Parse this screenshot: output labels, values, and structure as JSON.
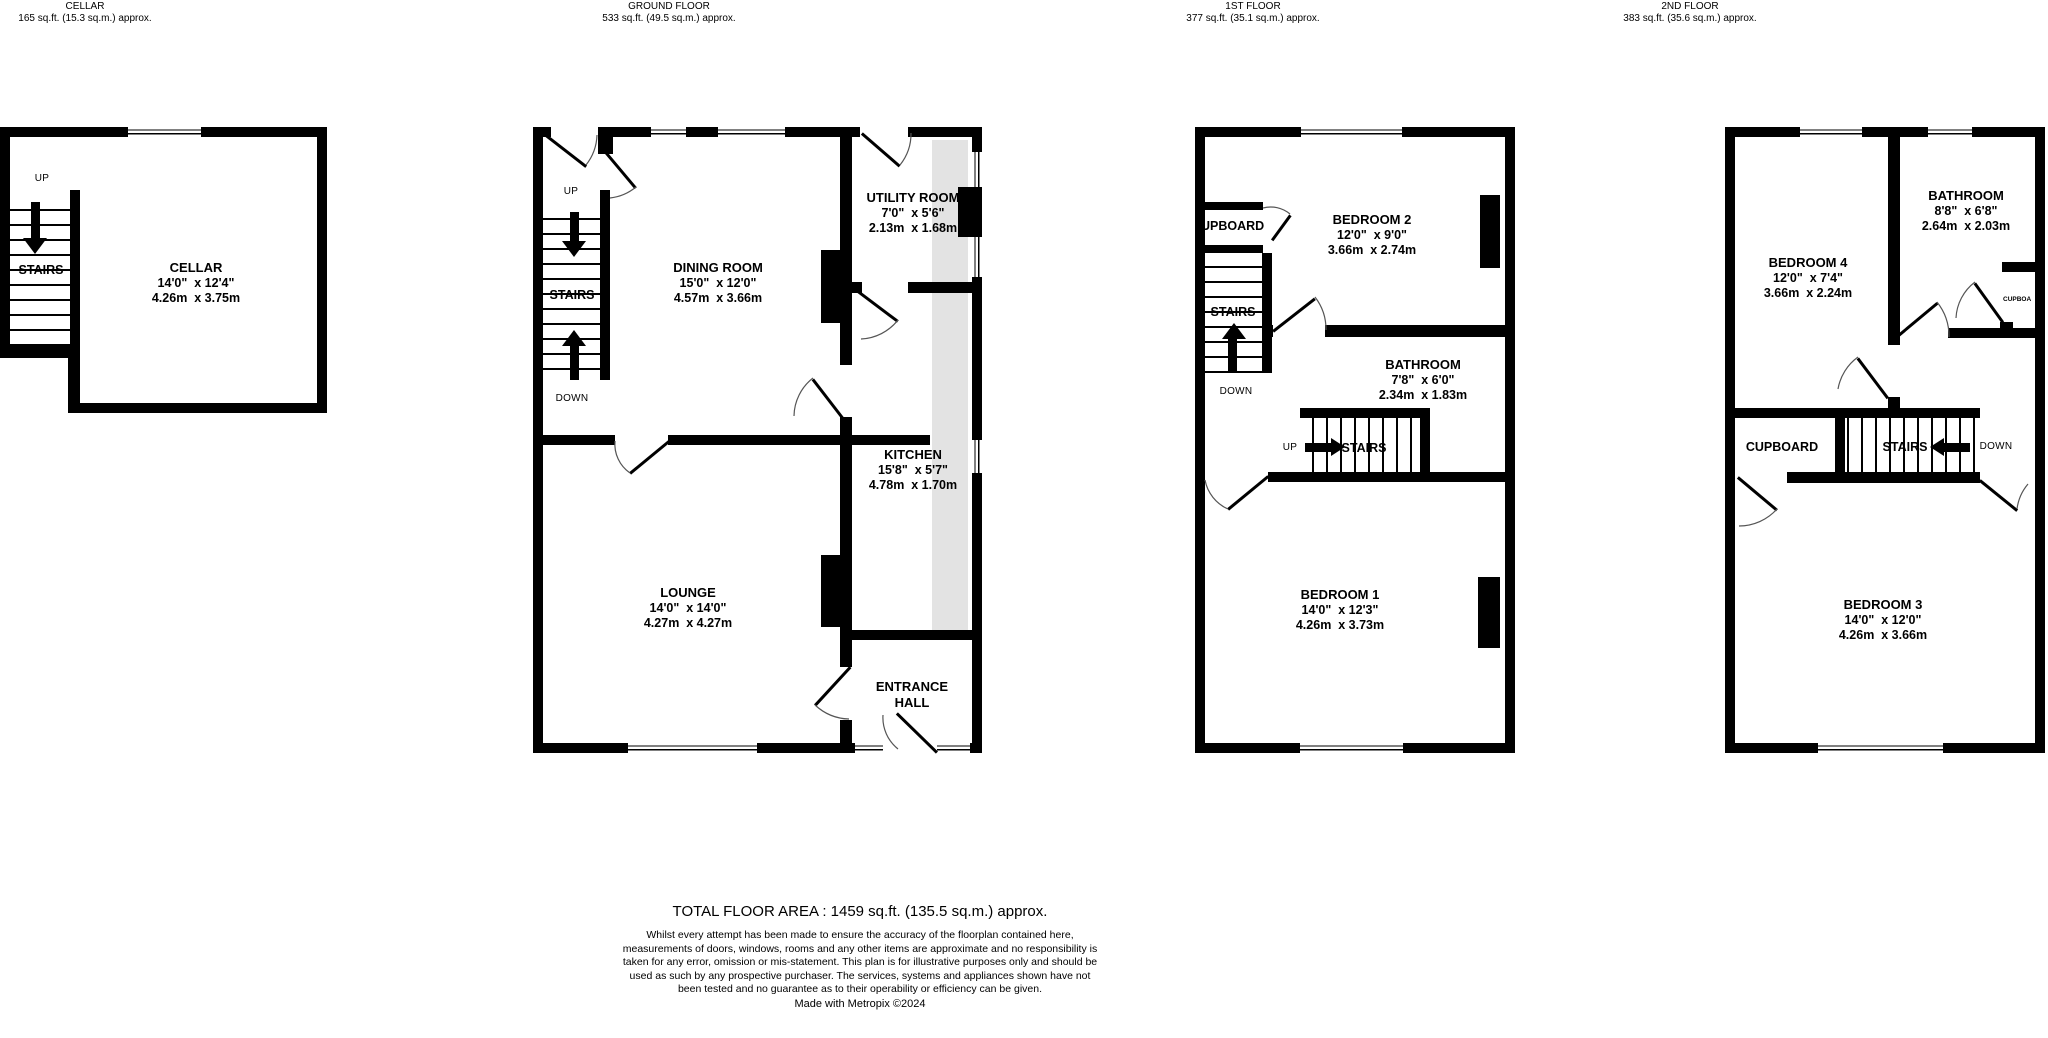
{
  "floors": [
    {
      "title": "CELLAR",
      "area": "165 sq.ft. (15.3 sq.m.) approx.",
      "rooms": [
        {
          "name": "CELLAR",
          "ft": "14'0\"  x 12'4\"",
          "m": "4.26m  x 3.75m"
        }
      ],
      "labels": {
        "stairs": "STAIRS",
        "up": "UP"
      }
    },
    {
      "title": "GROUND FLOOR",
      "area": "533 sq.ft. (49.5 sq.m.) approx.",
      "rooms": [
        {
          "name": "DINING ROOM",
          "ft": "15'0\"  x 12'0\"",
          "m": "4.57m  x 3.66m"
        },
        {
          "name": "UTILITY ROOM",
          "ft": "7'0\"  x 5'6\"",
          "m": "2.13m  x 1.68m"
        },
        {
          "name": "KITCHEN",
          "ft": "15'8\"  x 5'7\"",
          "m": "4.78m  x 1.70m"
        },
        {
          "name": "LOUNGE",
          "ft": "14'0\"  x 14'0\"",
          "m": "4.27m  x 4.27m"
        },
        {
          "name": "ENTRANCE HALL"
        }
      ],
      "labels": {
        "stairs": "STAIRS",
        "up": "UP",
        "down": "DOWN"
      }
    },
    {
      "title": "1ST FLOOR",
      "area": "377 sq.ft. (35.1 sq.m.) approx.",
      "rooms": [
        {
          "name": "BEDROOM 2",
          "ft": "12'0\"  x 9'0\"",
          "m": "3.66m  x 2.74m"
        },
        {
          "name": "BATHROOM",
          "ft": "7'8\"  x 6'0\"",
          "m": "2.34m  x 1.83m"
        },
        {
          "name": "BEDROOM 1",
          "ft": "14'0\"  x 12'3\"",
          "m": "4.26m  x 3.73m"
        }
      ],
      "labels": {
        "stairs": "STAIRS",
        "up": "UP",
        "down": "DOWN",
        "cupboard": "UPBOARD"
      }
    },
    {
      "title": "2ND FLOOR",
      "area": "383 sq.ft. (35.6 sq.m.) approx.",
      "rooms": [
        {
          "name": "BEDROOM 4",
          "ft": "12'0\"  x 7'4\"",
          "m": "3.66m  x 2.24m"
        },
        {
          "name": "BATHROOM",
          "ft": "8'8\"  x 6'8\"",
          "m": "2.64m  x 2.03m"
        },
        {
          "name": "BEDROOM 3",
          "ft": "14'0\"  x 12'0\"",
          "m": "4.26m  x 3.66m"
        }
      ],
      "labels": {
        "stairs": "STAIRS",
        "down": "DOWN",
        "cupboard": "CUPBOARD",
        "cupboard_small": "CUPBOA"
      }
    }
  ],
  "colors": {
    "wall": "#000000",
    "shade": "#e3e3e3"
  },
  "footer": {
    "total": "TOTAL FLOOR AREA : 1459 sq.ft. (135.5 sq.m.) approx.",
    "disclaimer": "Whilst every attempt has been made to ensure the accuracy of the floorplan contained here, measurements of doors, windows, rooms and any other items are approximate and no responsibility is taken for any error, omission or mis-statement. This plan is for illustrative purposes only and should be used as such by any prospective purchaser. The services, systems and appliances shown have not been tested and no guarantee as to their operability or efficiency can be given.",
    "credit": "Made with Metropix ©2024"
  }
}
